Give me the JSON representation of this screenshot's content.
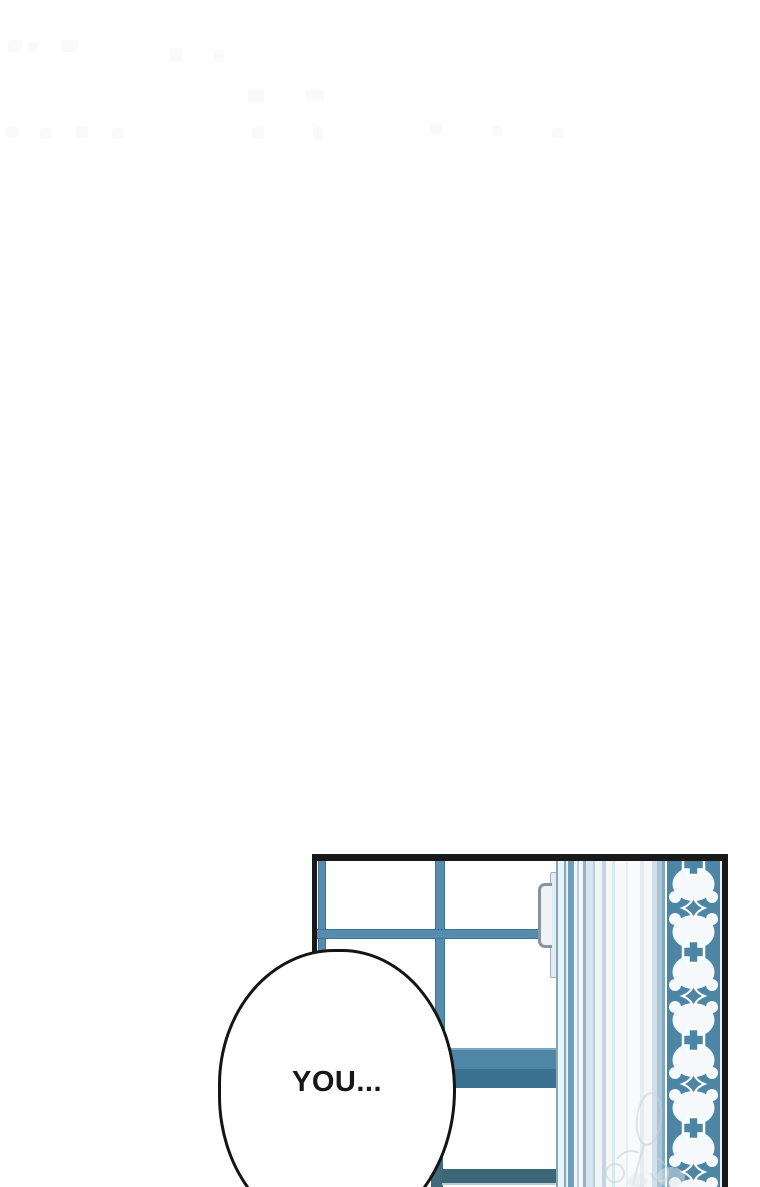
{
  "comic": {
    "speech_bubble": {
      "text": "YOU..."
    }
  },
  "colors": {
    "panel-border": "#191919",
    "frame-blue": "#568daf",
    "frame-blue-edge": "#3d7394",
    "band-top": "#4e87a6",
    "band-bottom": "#3a7290",
    "rail-dark": "#3c6876",
    "tile-teal": "#4d86a4",
    "tile-white": "#f6fafc",
    "bubble-outline": "#141414",
    "text": "#171717"
  },
  "decor": {
    "tile_pattern": "quatrefoil-tile-border",
    "curtain": "vertical-striped-curtain",
    "watermark": "faint-sketch-watermark",
    "faint_marks": "ghosted-page-smudges"
  }
}
